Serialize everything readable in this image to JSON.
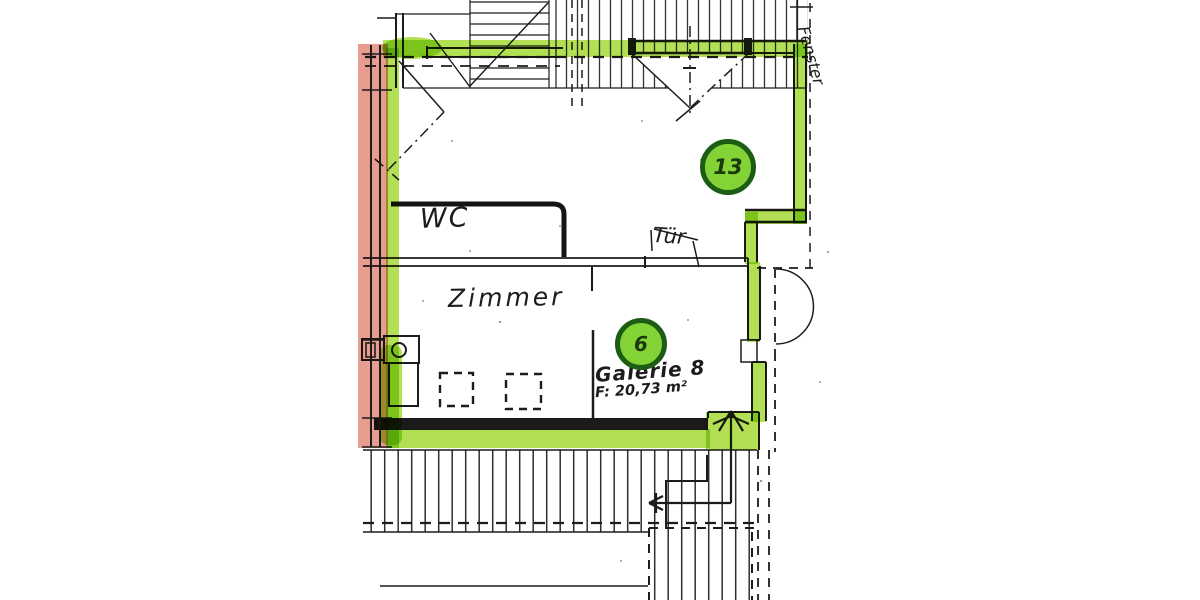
{
  "labels": {
    "room_top_number": "13",
    "gallery_number": "6",
    "wc": "WC",
    "tuer": "Tür",
    "zimmer": "Zimmer",
    "galerie": "Galerie 8",
    "galerie_area": "F: 20,73 m²",
    "fenster": "Fenster"
  },
  "colors": {
    "highlight_green": "#a4d936",
    "highlight_red": "#dd7b69",
    "circle_fill": "#84d336",
    "circle_ring": "#1d5c15",
    "ink": "#1c1c1c",
    "paper": "#ffffff"
  }
}
